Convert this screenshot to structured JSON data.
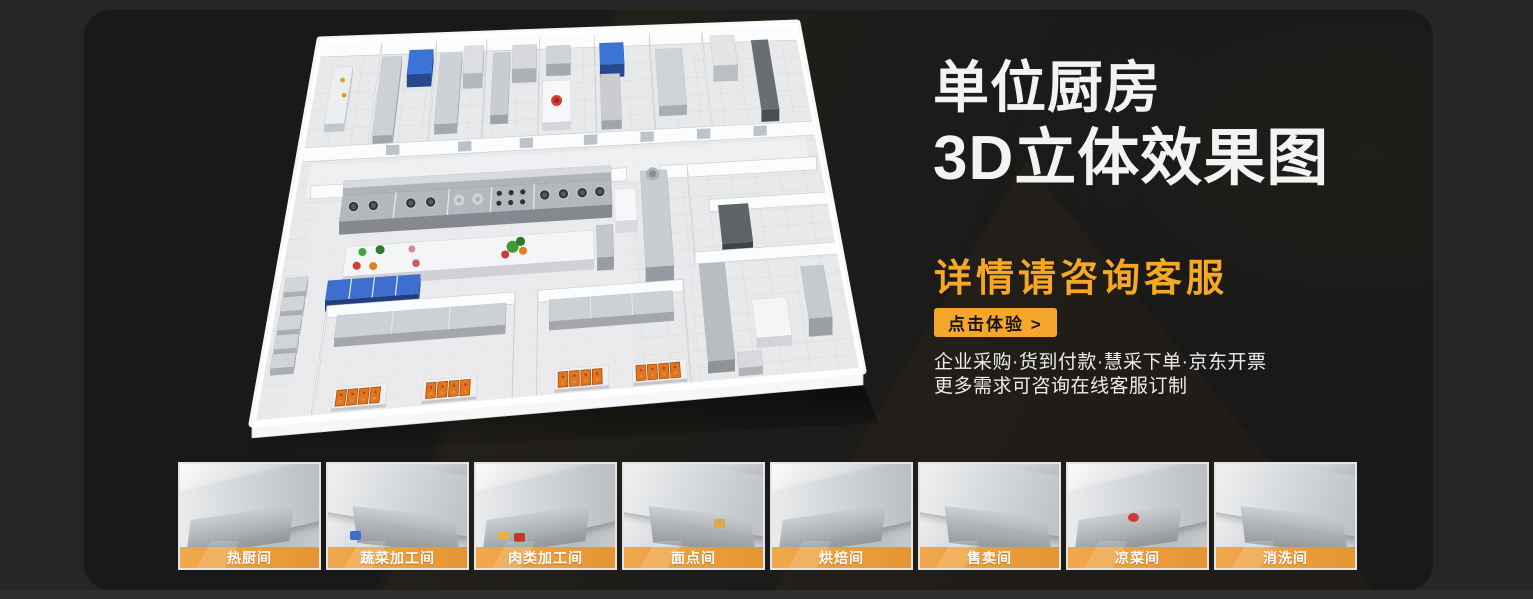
{
  "page": {
    "background_color": "#262626",
    "panel_color": "#191919",
    "accent_color": "#F6A62B",
    "heading_orange": "#F7A823"
  },
  "hero": {
    "title_line1": "单位厨房",
    "title_line2": "3D立体效果图",
    "subtitle": "详情请咨询客服",
    "cta_label": "点击体验 >",
    "info_lines": [
      "企业采购·货到付款·慧采下单·京东开票",
      "更多需求可咨询在线客服订制"
    ]
  },
  "gallery": {
    "items": [
      {
        "label": "热厨间"
      },
      {
        "label": "蔬菜加工间"
      },
      {
        "label": "肉类加工间"
      },
      {
        "label": "面点间"
      },
      {
        "label": "烘焙间"
      },
      {
        "label": "售卖间"
      },
      {
        "label": "凉菜间"
      },
      {
        "label": "消洗间"
      }
    ]
  }
}
